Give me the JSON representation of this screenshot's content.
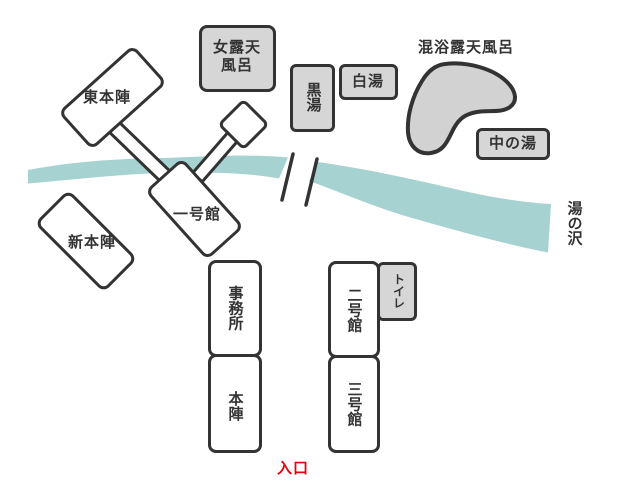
{
  "colors": {
    "river": "#a6d3d1",
    "bath_fill": "#d6d6d6",
    "building_fill": "#ffffff",
    "outline": "#333333",
    "label_text": "#333333",
    "entrance_text": "#e60012"
  },
  "labels": {
    "higashi_honjin": "東本陣",
    "onna_rotenburo": "女露天\n風呂",
    "kuroyu": "黒湯",
    "shirayu": "白湯",
    "konyoku_rotenburo": "混浴露天風呂",
    "naka_no_yu": "中の湯",
    "yunosawa": "湯の沢",
    "shin_honjin": "新本陣",
    "ichigokan": "一号館",
    "jimusho": "事務所",
    "honjin": "本陣",
    "nigokan": "二号館",
    "sangokan": "三号館",
    "toilet": "トイレ",
    "entrance": "入口"
  }
}
